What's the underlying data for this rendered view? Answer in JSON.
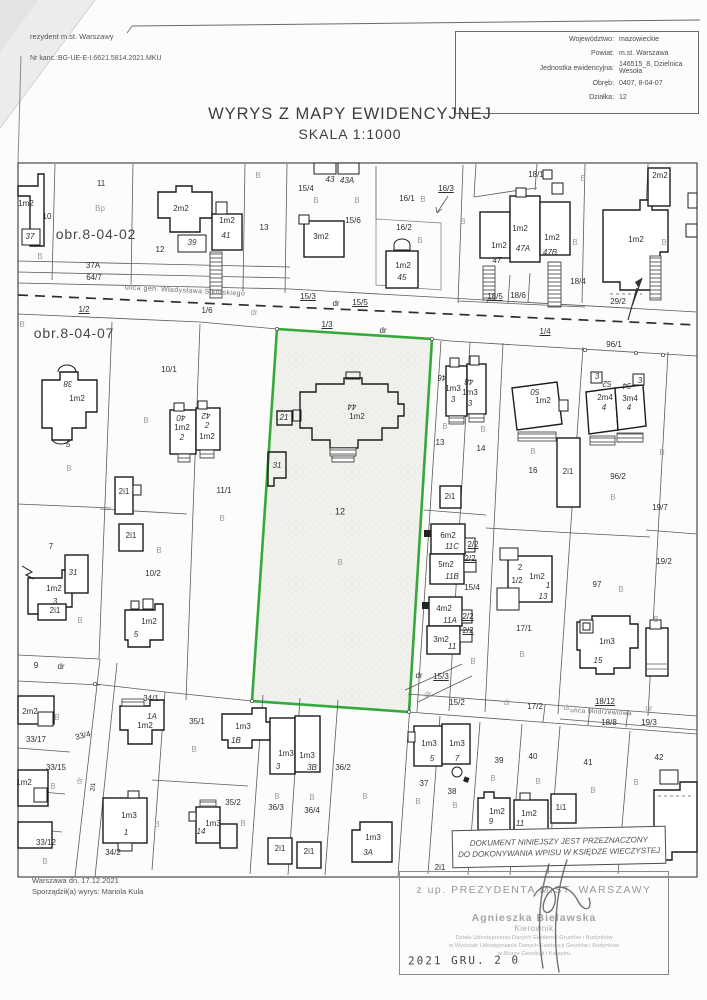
{
  "header": {
    "office_line": "rezydent m.st. Warszawy",
    "case_no": "Nr kanc.:BG-UE-E-I.6621.5814.2021.MKU",
    "info": {
      "rows": [
        {
          "label": "Województwo:",
          "value": "mazowieckie"
        },
        {
          "label": "Powiat:",
          "value": "m.st. Warszawa"
        },
        {
          "label": "Jednostka ewidencyjna:",
          "value": "146515_8, Dzielnica Wesoła"
        },
        {
          "label": "Obręb:",
          "value": "0407, 8-04-07"
        },
        {
          "label": "Działka:",
          "value": "12"
        }
      ]
    }
  },
  "title": {
    "line1": "WYRYS Z MAPY EWIDENCYJNEJ",
    "line2": "SKALA 1:1000"
  },
  "footer": {
    "date_line": "Warszawa dn. 17.12.2021",
    "author_line": "Sporządził(a) wyrys: Mariola Kula"
  },
  "stamps": {
    "purpose_line1": "DOKUMENT NINIEJSZY JEST PRZEZNACZONY",
    "purpose_line2": "DO DOKONYWANIA WPISU W KSIĘDZE WIECZYSTEJ",
    "authority": "z up. PREZYDENTA M.ST. WARSZAWY",
    "signer_name": "Agnieszka Bielawska",
    "signer_title": "Kierownik",
    "signer_dept1": "Działu Udostępniania Danych Ewidencji Gruntów i Budynków",
    "signer_dept2": "w Wydziale Udostępniania Danych Ewidencji Gruntów i Budynków",
    "signer_dept3": "w Biurze Geodezji i Katastru",
    "date_stamp": "2021 GRU. 2 0"
  },
  "colors": {
    "parcel_highlight": "#36a93c",
    "building_line": "#1c1c1c",
    "parcel_line": "#555555"
  },
  "map": {
    "subject_parcel": "12",
    "labels": [
      {
        "t": "1m2",
        "x": 26,
        "y": 204
      },
      {
        "t": "37",
        "x": 30,
        "y": 237,
        "c": "i"
      },
      {
        "t": "10",
        "x": 47,
        "y": 217
      },
      {
        "t": "B",
        "x": 40,
        "y": 257,
        "c": "g"
      },
      {
        "t": "11",
        "x": 101,
        "y": 184
      },
      {
        "t": "Bp",
        "x": 100,
        "y": 209,
        "c": "g"
      },
      {
        "t": "obr.8-04-02",
        "x": 96,
        "y": 234,
        "s": 14,
        "c": "obr"
      },
      {
        "t": "12",
        "x": 160,
        "y": 250
      },
      {
        "t": "2m2",
        "x": 181,
        "y": 209
      },
      {
        "t": "39",
        "x": 192,
        "y": 243,
        "c": "i"
      },
      {
        "t": "1m2",
        "x": 227,
        "y": 221
      },
      {
        "t": "41",
        "x": 226,
        "y": 236,
        "c": "i"
      },
      {
        "t": "37A",
        "x": 93,
        "y": 266
      },
      {
        "t": "64/7",
        "x": 94,
        "y": 278
      },
      {
        "t": "ulica gen. Władysława Sikorskiego",
        "x": 185,
        "y": 291,
        "s": 7,
        "r": 3,
        "c": "st"
      },
      {
        "t": "1/2",
        "x": 84,
        "y": 310,
        "c": "u"
      },
      {
        "t": "1/6",
        "x": 207,
        "y": 311
      },
      {
        "t": "B",
        "x": 258,
        "y": 176,
        "c": "g"
      },
      {
        "t": "13",
        "x": 264,
        "y": 228
      },
      {
        "t": "15/4",
        "x": 306,
        "y": 189
      },
      {
        "t": "B",
        "x": 316,
        "y": 201,
        "c": "g"
      },
      {
        "t": "43",
        "x": 330,
        "y": 180,
        "c": "i"
      },
      {
        "t": "43A",
        "x": 347,
        "y": 181,
        "c": "i"
      },
      {
        "t": "3m2",
        "x": 321,
        "y": 237
      },
      {
        "t": "15/6",
        "x": 353,
        "y": 221
      },
      {
        "t": "B",
        "x": 357,
        "y": 201,
        "c": "g"
      },
      {
        "t": "16/1",
        "x": 407,
        "y": 199
      },
      {
        "t": "B",
        "x": 423,
        "y": 200,
        "c": "g"
      },
      {
        "t": "16/3",
        "x": 446,
        "y": 189,
        "c": "u"
      },
      {
        "t": "16/2",
        "x": 404,
        "y": 228
      },
      {
        "t": "B",
        "x": 420,
        "y": 241,
        "c": "g"
      },
      {
        "t": "1m2",
        "x": 403,
        "y": 266
      },
      {
        "t": "45",
        "x": 402,
        "y": 278,
        "c": "i"
      },
      {
        "t": "15/3",
        "x": 308,
        "y": 297,
        "c": "u"
      },
      {
        "t": "dr",
        "x": 336,
        "y": 304
      },
      {
        "t": "15/5",
        "x": 360,
        "y": 303,
        "c": "u"
      },
      {
        "t": "dr",
        "x": 254,
        "y": 313,
        "c": "g"
      },
      {
        "t": "18/1",
        "x": 536,
        "y": 175
      },
      {
        "t": "B",
        "x": 583,
        "y": 179,
        "c": "g"
      },
      {
        "t": "2m2",
        "x": 660,
        "y": 176
      },
      {
        "t": "B",
        "x": 463,
        "y": 222,
        "c": "g"
      },
      {
        "t": "1m2",
        "x": 520,
        "y": 229
      },
      {
        "t": "47A",
        "x": 523,
        "y": 249,
        "c": "i"
      },
      {
        "t": "1m2",
        "x": 499,
        "y": 246
      },
      {
        "t": "47",
        "x": 497,
        "y": 261,
        "c": "i"
      },
      {
        "t": "1m2",
        "x": 552,
        "y": 238
      },
      {
        "t": "47B",
        "x": 550,
        "y": 253,
        "c": "i"
      },
      {
        "t": "B",
        "x": 575,
        "y": 243,
        "c": "g"
      },
      {
        "t": "18/4",
        "x": 578,
        "y": 282
      },
      {
        "t": "18/5",
        "x": 495,
        "y": 297,
        "c": "u"
      },
      {
        "t": "18/6",
        "x": 518,
        "y": 296
      },
      {
        "t": "29/2",
        "x": 618,
        "y": 302
      },
      {
        "t": "1m2",
        "x": 636,
        "y": 240
      },
      {
        "t": "B",
        "x": 664,
        "y": 243,
        "c": "g"
      },
      {
        "t": "obr.8-04-07",
        "x": 74,
        "y": 333,
        "s": 14,
        "c": "obr"
      },
      {
        "t": "1/3",
        "x": 327,
        "y": 325,
        "c": "u"
      },
      {
        "t": "dr",
        "x": 383,
        "y": 331
      },
      {
        "t": "1/4",
        "x": 545,
        "y": 332,
        "c": "u"
      },
      {
        "t": "96/1",
        "x": 614,
        "y": 345
      },
      {
        "t": "B",
        "x": 22,
        "y": 325,
        "c": "g"
      },
      {
        "t": "10/1",
        "x": 169,
        "y": 370
      },
      {
        "t": "38",
        "x": 68,
        "y": 383,
        "c": "i",
        "r": 180
      },
      {
        "t": "1m2",
        "x": 77,
        "y": 399
      },
      {
        "t": "5",
        "x": 68,
        "y": 445,
        "c": "i"
      },
      {
        "t": "B",
        "x": 69,
        "y": 469,
        "c": "g"
      },
      {
        "t": "B",
        "x": 146,
        "y": 421,
        "c": "g"
      },
      {
        "t": "40",
        "x": 181,
        "y": 417,
        "c": "i",
        "r": 180
      },
      {
        "t": "1m2",
        "x": 182,
        "y": 428
      },
      {
        "t": "2",
        "x": 182,
        "y": 438,
        "c": "i"
      },
      {
        "t": "42",
        "x": 206,
        "y": 415,
        "c": "i",
        "r": 180
      },
      {
        "t": "2",
        "x": 207,
        "y": 426,
        "c": "i"
      },
      {
        "t": "1m2",
        "x": 207,
        "y": 437
      },
      {
        "t": "11/1",
        "x": 224,
        "y": 491
      },
      {
        "t": "B",
        "x": 222,
        "y": 519,
        "c": "g"
      },
      {
        "t": "21",
        "x": 284,
        "y": 418,
        "c": "i"
      },
      {
        "t": "31",
        "x": 277,
        "y": 466,
        "c": "i"
      },
      {
        "t": "44",
        "x": 352,
        "y": 406,
        "c": "i",
        "r": 180
      },
      {
        "t": "1m2",
        "x": 357,
        "y": 417
      },
      {
        "t": "12",
        "x": 340,
        "y": 512,
        "s": 9
      },
      {
        "t": "B",
        "x": 340,
        "y": 563,
        "c": "g"
      },
      {
        "t": "46",
        "x": 442,
        "y": 377,
        "c": "i",
        "r": 180
      },
      {
        "t": "1m3",
        "x": 453,
        "y": 389
      },
      {
        "t": "3",
        "x": 453,
        "y": 400,
        "c": "i"
      },
      {
        "t": "48",
        "x": 469,
        "y": 381,
        "c": "i",
        "r": 180
      },
      {
        "t": "1m3",
        "x": 470,
        "y": 393
      },
      {
        "t": "3",
        "x": 470,
        "y": 404,
        "c": "i"
      },
      {
        "t": "B",
        "x": 445,
        "y": 427,
        "c": "g"
      },
      {
        "t": "B",
        "x": 483,
        "y": 430,
        "c": "g"
      },
      {
        "t": "13",
        "x": 440,
        "y": 443
      },
      {
        "t": "14",
        "x": 481,
        "y": 449
      },
      {
        "t": "50",
        "x": 535,
        "y": 391,
        "c": "i",
        "r": 180
      },
      {
        "t": "1m2",
        "x": 543,
        "y": 401
      },
      {
        "t": "3",
        "x": 597,
        "y": 377,
        "c": "i"
      },
      {
        "t": "52",
        "x": 607,
        "y": 383,
        "c": "i",
        "r": 180
      },
      {
        "t": "2m4",
        "x": 605,
        "y": 398
      },
      {
        "t": "4",
        "x": 604,
        "y": 408,
        "c": "i"
      },
      {
        "t": "54",
        "x": 627,
        "y": 385,
        "c": "i",
        "r": 180
      },
      {
        "t": "3",
        "x": 640,
        "y": 381,
        "c": "i"
      },
      {
        "t": "3m4",
        "x": 630,
        "y": 399
      },
      {
        "t": "4",
        "x": 629,
        "y": 408,
        "c": "i"
      },
      {
        "t": "B",
        "x": 533,
        "y": 452,
        "c": "g"
      },
      {
        "t": "16",
        "x": 533,
        "y": 471
      },
      {
        "t": "2i1",
        "x": 568,
        "y": 472
      },
      {
        "t": "96/2",
        "x": 618,
        "y": 477
      },
      {
        "t": "B",
        "x": 613,
        "y": 498,
        "c": "g"
      },
      {
        "t": "19/7",
        "x": 660,
        "y": 508
      },
      {
        "t": "B",
        "x": 662,
        "y": 453,
        "c": "g"
      },
      {
        "t": "2i1",
        "x": 450,
        "y": 497
      },
      {
        "t": "6m2",
        "x": 448,
        "y": 536
      },
      {
        "t": "11C",
        "x": 452,
        "y": 547,
        "c": "i"
      },
      {
        "t": "5m2",
        "x": 446,
        "y": 565
      },
      {
        "t": "11B",
        "x": 452,
        "y": 577,
        "c": "i"
      },
      {
        "t": "2/2",
        "x": 473,
        "y": 545,
        "c": "u"
      },
      {
        "t": "2/2",
        "x": 470,
        "y": 559,
        "c": "u"
      },
      {
        "t": "15/4",
        "x": 472,
        "y": 588
      },
      {
        "t": "4m2",
        "x": 444,
        "y": 609
      },
      {
        "t": "11A",
        "x": 450,
        "y": 621,
        "c": "i"
      },
      {
        "t": "2/2",
        "x": 468,
        "y": 617,
        "c": "u"
      },
      {
        "t": "2/2",
        "x": 468,
        "y": 631,
        "c": "u"
      },
      {
        "t": "3m2",
        "x": 441,
        "y": 640
      },
      {
        "t": "11",
        "x": 452,
        "y": 647,
        "c": "i"
      },
      {
        "t": "B",
        "x": 473,
        "y": 662,
        "c": "g"
      },
      {
        "t": "2",
        "x": 520,
        "y": 568
      },
      {
        "t": "1/2",
        "x": 517,
        "y": 581
      },
      {
        "t": "1m2",
        "x": 537,
        "y": 577
      },
      {
        "t": "1",
        "x": 548,
        "y": 586,
        "c": "i"
      },
      {
        "t": "13",
        "x": 543,
        "y": 597,
        "c": "i"
      },
      {
        "t": "17/1",
        "x": 524,
        "y": 629
      },
      {
        "t": "B",
        "x": 522,
        "y": 655,
        "c": "g"
      },
      {
        "t": "97",
        "x": 597,
        "y": 585
      },
      {
        "t": "B",
        "x": 621,
        "y": 590,
        "c": "g"
      },
      {
        "t": "1m3",
        "x": 607,
        "y": 642
      },
      {
        "t": "15",
        "x": 598,
        "y": 661,
        "c": "i"
      },
      {
        "t": "19/2",
        "x": 664,
        "y": 562
      },
      {
        "t": "B",
        "x": 656,
        "y": 620,
        "c": "g"
      },
      {
        "t": "7",
        "x": 51,
        "y": 547
      },
      {
        "t": "31",
        "x": 73,
        "y": 573,
        "c": "i"
      },
      {
        "t": "1m2",
        "x": 54,
        "y": 589
      },
      {
        "t": "3",
        "x": 55,
        "y": 602,
        "c": "i"
      },
      {
        "t": "2i1",
        "x": 55,
        "y": 611
      },
      {
        "t": "B",
        "x": 80,
        "y": 621,
        "c": "g"
      },
      {
        "t": "10/2",
        "x": 153,
        "y": 574
      },
      {
        "t": "2i1",
        "x": 124,
        "y": 492
      },
      {
        "t": "2i1",
        "x": 131,
        "y": 536
      },
      {
        "t": "B",
        "x": 159,
        "y": 551,
        "c": "g"
      },
      {
        "t": "1m2",
        "x": 149,
        "y": 622
      },
      {
        "t": "5",
        "x": 136,
        "y": 635,
        "c": "i"
      },
      {
        "t": "9",
        "x": 36,
        "y": 666
      },
      {
        "t": "dr",
        "x": 61,
        "y": 667
      },
      {
        "t": "dr",
        "x": 419,
        "y": 676
      },
      {
        "t": "15/3",
        "x": 441,
        "y": 677,
        "c": "u"
      },
      {
        "t": "dr",
        "x": 428,
        "y": 695,
        "c": "g"
      },
      {
        "t": "15/2",
        "x": 457,
        "y": 703
      },
      {
        "t": "dr",
        "x": 507,
        "y": 703,
        "c": "g"
      },
      {
        "t": "17/2",
        "x": 535,
        "y": 707
      },
      {
        "t": "dr",
        "x": 567,
        "y": 708,
        "c": "g"
      },
      {
        "t": "18/12",
        "x": 605,
        "y": 702,
        "c": "u"
      },
      {
        "t": "ulica Modrzewiowa",
        "x": 601,
        "y": 713,
        "s": 6.5,
        "r": 3,
        "c": "st"
      },
      {
        "t": "dr",
        "x": 649,
        "y": 709,
        "c": "g"
      },
      {
        "t": "18/8",
        "x": 609,
        "y": 723
      },
      {
        "t": "19/3",
        "x": 649,
        "y": 723
      },
      {
        "t": "34/1",
        "x": 151,
        "y": 699
      },
      {
        "t": "33/4",
        "x": 83,
        "y": 736,
        "r": -14
      },
      {
        "t": "2m2",
        "x": 30,
        "y": 712
      },
      {
        "t": "B",
        "x": 57,
        "y": 718,
        "c": "g"
      },
      {
        "t": "33/17",
        "x": 36,
        "y": 740
      },
      {
        "t": "1A",
        "x": 152,
        "y": 717,
        "c": "i"
      },
      {
        "t": "1m2",
        "x": 145,
        "y": 726
      },
      {
        "t": "35/1",
        "x": 197,
        "y": 722
      },
      {
        "t": "B",
        "x": 194,
        "y": 750,
        "c": "g"
      },
      {
        "t": "1m3",
        "x": 243,
        "y": 727
      },
      {
        "t": "1B",
        "x": 236,
        "y": 741,
        "c": "i"
      },
      {
        "t": "33/15",
        "x": 56,
        "y": 768
      },
      {
        "t": "1m2",
        "x": 24,
        "y": 783
      },
      {
        "t": "B",
        "x": 53,
        "y": 787,
        "c": "g"
      },
      {
        "t": "dr",
        "x": 80,
        "y": 781,
        "r": -72,
        "c": "g"
      },
      {
        "t": "2i1",
        "x": 94,
        "y": 787,
        "r": -85,
        "s": 6.5
      },
      {
        "t": "1m3",
        "x": 129,
        "y": 816
      },
      {
        "t": "1",
        "x": 126,
        "y": 833,
        "c": "i"
      },
      {
        "t": "B",
        "x": 157,
        "y": 825,
        "c": "g"
      },
      {
        "t": "33/12",
        "x": 46,
        "y": 843
      },
      {
        "t": "34/2",
        "x": 113,
        "y": 853
      },
      {
        "t": "B",
        "x": 45,
        "y": 862,
        "c": "g"
      },
      {
        "t": "35/2",
        "x": 233,
        "y": 803
      },
      {
        "t": "1m3",
        "x": 213,
        "y": 824
      },
      {
        "t": "14",
        "x": 201,
        "y": 832,
        "c": "i"
      },
      {
        "t": "B",
        "x": 243,
        "y": 824,
        "c": "g"
      },
      {
        "t": "1m3",
        "x": 286,
        "y": 754
      },
      {
        "t": "3",
        "x": 278,
        "y": 767,
        "c": "i"
      },
      {
        "t": "1m3",
        "x": 307,
        "y": 756
      },
      {
        "t": "3B",
        "x": 312,
        "y": 768,
        "c": "i"
      },
      {
        "t": "36/2",
        "x": 343,
        "y": 768
      },
      {
        "t": "B",
        "x": 365,
        "y": 797,
        "c": "g"
      },
      {
        "t": "B",
        "x": 277,
        "y": 797,
        "c": "g"
      },
      {
        "t": "36/3",
        "x": 276,
        "y": 808
      },
      {
        "t": "B",
        "x": 312,
        "y": 798,
        "c": "g"
      },
      {
        "t": "36/4",
        "x": 312,
        "y": 811
      },
      {
        "t": "2i1",
        "x": 280,
        "y": 849
      },
      {
        "t": "2i1",
        "x": 309,
        "y": 852
      },
      {
        "t": "1m3",
        "x": 373,
        "y": 838
      },
      {
        "t": "3A",
        "x": 368,
        "y": 853,
        "c": "i"
      },
      {
        "t": "1m3",
        "x": 429,
        "y": 744
      },
      {
        "t": "5",
        "x": 432,
        "y": 759,
        "c": "i"
      },
      {
        "t": "1m3",
        "x": 457,
        "y": 744
      },
      {
        "t": "7",
        "x": 457,
        "y": 759,
        "c": "i"
      },
      {
        "t": "37",
        "x": 424,
        "y": 784
      },
      {
        "t": "38",
        "x": 452,
        "y": 792
      },
      {
        "t": "B",
        "x": 418,
        "y": 802,
        "c": "g"
      },
      {
        "t": "B",
        "x": 455,
        "y": 806,
        "c": "g"
      },
      {
        "t": "39",
        "x": 499,
        "y": 761
      },
      {
        "t": "B",
        "x": 493,
        "y": 779,
        "c": "g"
      },
      {
        "t": "40",
        "x": 533,
        "y": 757
      },
      {
        "t": "B",
        "x": 538,
        "y": 782,
        "c": "g"
      },
      {
        "t": "41",
        "x": 588,
        "y": 763
      },
      {
        "t": "B",
        "x": 593,
        "y": 791,
        "c": "g"
      },
      {
        "t": "42",
        "x": 659,
        "y": 758
      },
      {
        "t": "B",
        "x": 636,
        "y": 783,
        "c": "g"
      },
      {
        "t": "1m2",
        "x": 497,
        "y": 812
      },
      {
        "t": "9",
        "x": 491,
        "y": 822,
        "c": "i"
      },
      {
        "t": "1m2",
        "x": 529,
        "y": 814
      },
      {
        "t": "11",
        "x": 520,
        "y": 824,
        "c": "i"
      },
      {
        "t": "1i1",
        "x": 561,
        "y": 808
      },
      {
        "t": "2i1",
        "x": 440,
        "y": 868
      }
    ]
  }
}
